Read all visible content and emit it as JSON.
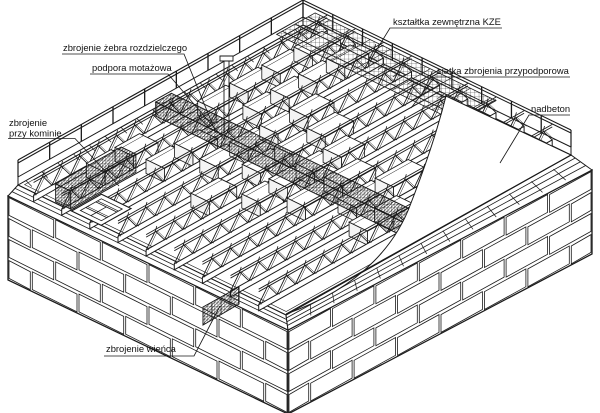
{
  "diagram": {
    "type": "axonometric-construction-drawing",
    "subject": "ribbed-floor-slab-assembly",
    "labels": {
      "zebro": "zbrojenie żebra rozdzielczego",
      "podpora": "podpora motażowa",
      "komin_line1": "zbrojenie",
      "komin_line2": "przy kominie",
      "kze": "kształtka zewnętrzna KZE",
      "siatka": "siatka zbrojenia przypodporowa",
      "nadbeton": "nadbeton",
      "wieniec": "zbrojenie wieńca"
    },
    "colors": {
      "ink": "#1a1a1a",
      "paper": "#ffffff"
    }
  }
}
